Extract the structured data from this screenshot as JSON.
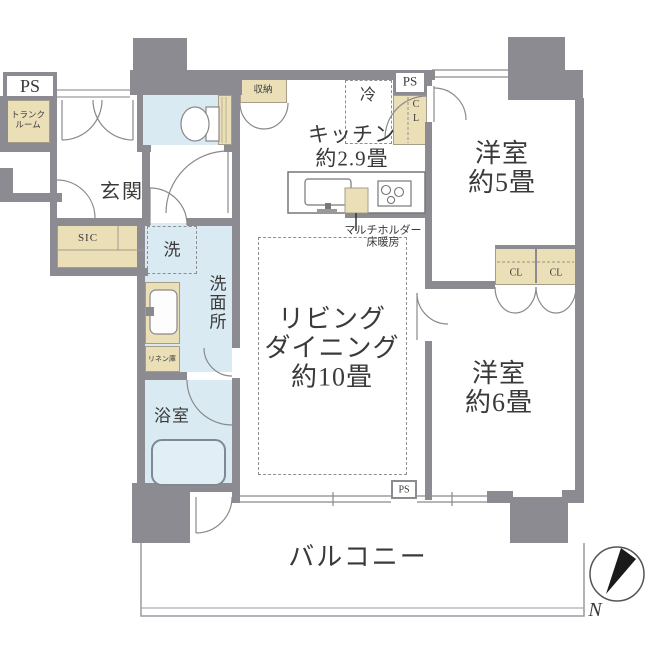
{
  "floorplan": {
    "title": "apartment-floor-plan",
    "labels": {
      "ps_top": "PS",
      "trunk_1": "トランク",
      "trunk_2": "ルーム",
      "genkan": "玄関",
      "sic": "SIC",
      "washer": "洗",
      "washroom": "洗面所",
      "linen": "リネン庫",
      "bath": "浴室",
      "storage": "収納",
      "fridge": "冷",
      "ps_kitchen": "PS",
      "cl_c": "C",
      "cl_l": "L",
      "kitchen_1": "キッチン",
      "kitchen_2": "約2.9畳",
      "multi_1": "マルチホルダー",
      "multi_2": "床暖房",
      "living_1": "リビング",
      "living_2": "ダイニング",
      "living_3": "約10畳",
      "room5_1": "洋室",
      "room5_2": "約5畳",
      "cl_left": "CL",
      "cl_right": "CL",
      "room6_1": "洋室",
      "room6_2": "約6畳",
      "ps_bottom": "PS",
      "balcony": "バルコニー",
      "north": "N"
    },
    "colors": {
      "wall": "#8b8b91",
      "closet": "#ebdfb8",
      "water_area": "#daeaf3",
      "line": "#8a8a8a",
      "text": "#3a3a3a"
    }
  }
}
